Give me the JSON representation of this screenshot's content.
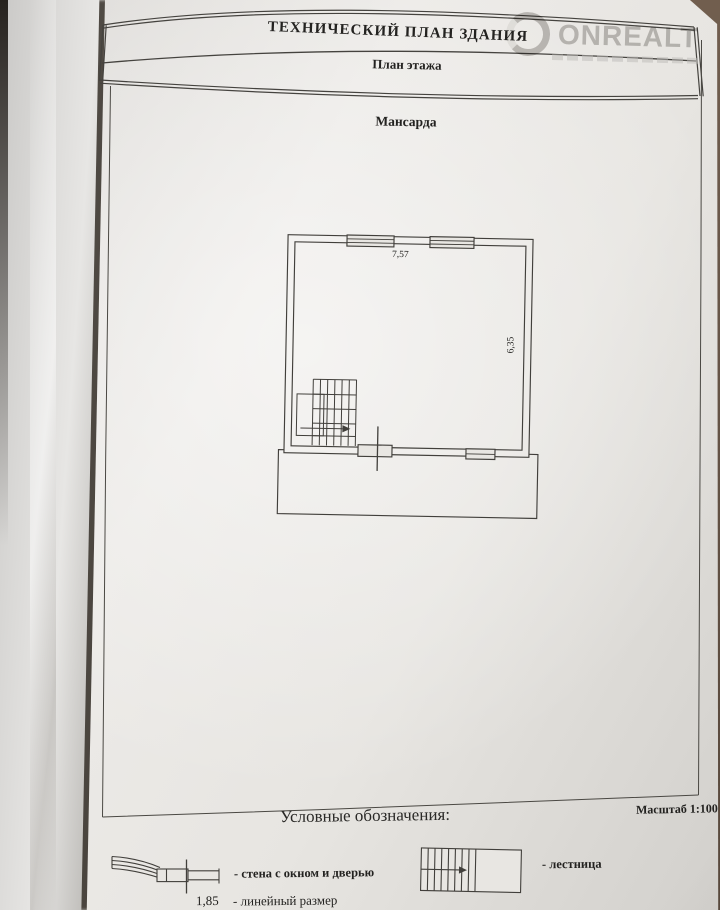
{
  "colors": {
    "backdrop": "#6a584a",
    "paper": "#e8e6e2",
    "line": "#413f3b",
    "watermark_gray": "#b2b0ad"
  },
  "watermark": {
    "text": "ONREALT"
  },
  "header": {
    "title": "ТЕХНИЧЕСКИЙ ПЛАН ЗДАНИЯ",
    "subtitle": "План этажа"
  },
  "plan": {
    "floor_label": "Мансарда",
    "dimensions": {
      "top_width_m": "7,57",
      "right_height_m": "6,35"
    }
  },
  "legend": {
    "heading": "Условные обозначения:",
    "scale_label": "Масштаб 1:100",
    "items": [
      {
        "symbol": "wall-with-window-and-door",
        "label": "- стена с окном и дверью"
      },
      {
        "symbol": "stairs",
        "label": "- лестница"
      },
      {
        "symbol": "linear-dimension",
        "value": "1,85",
        "label": "- линейный размер"
      }
    ]
  }
}
